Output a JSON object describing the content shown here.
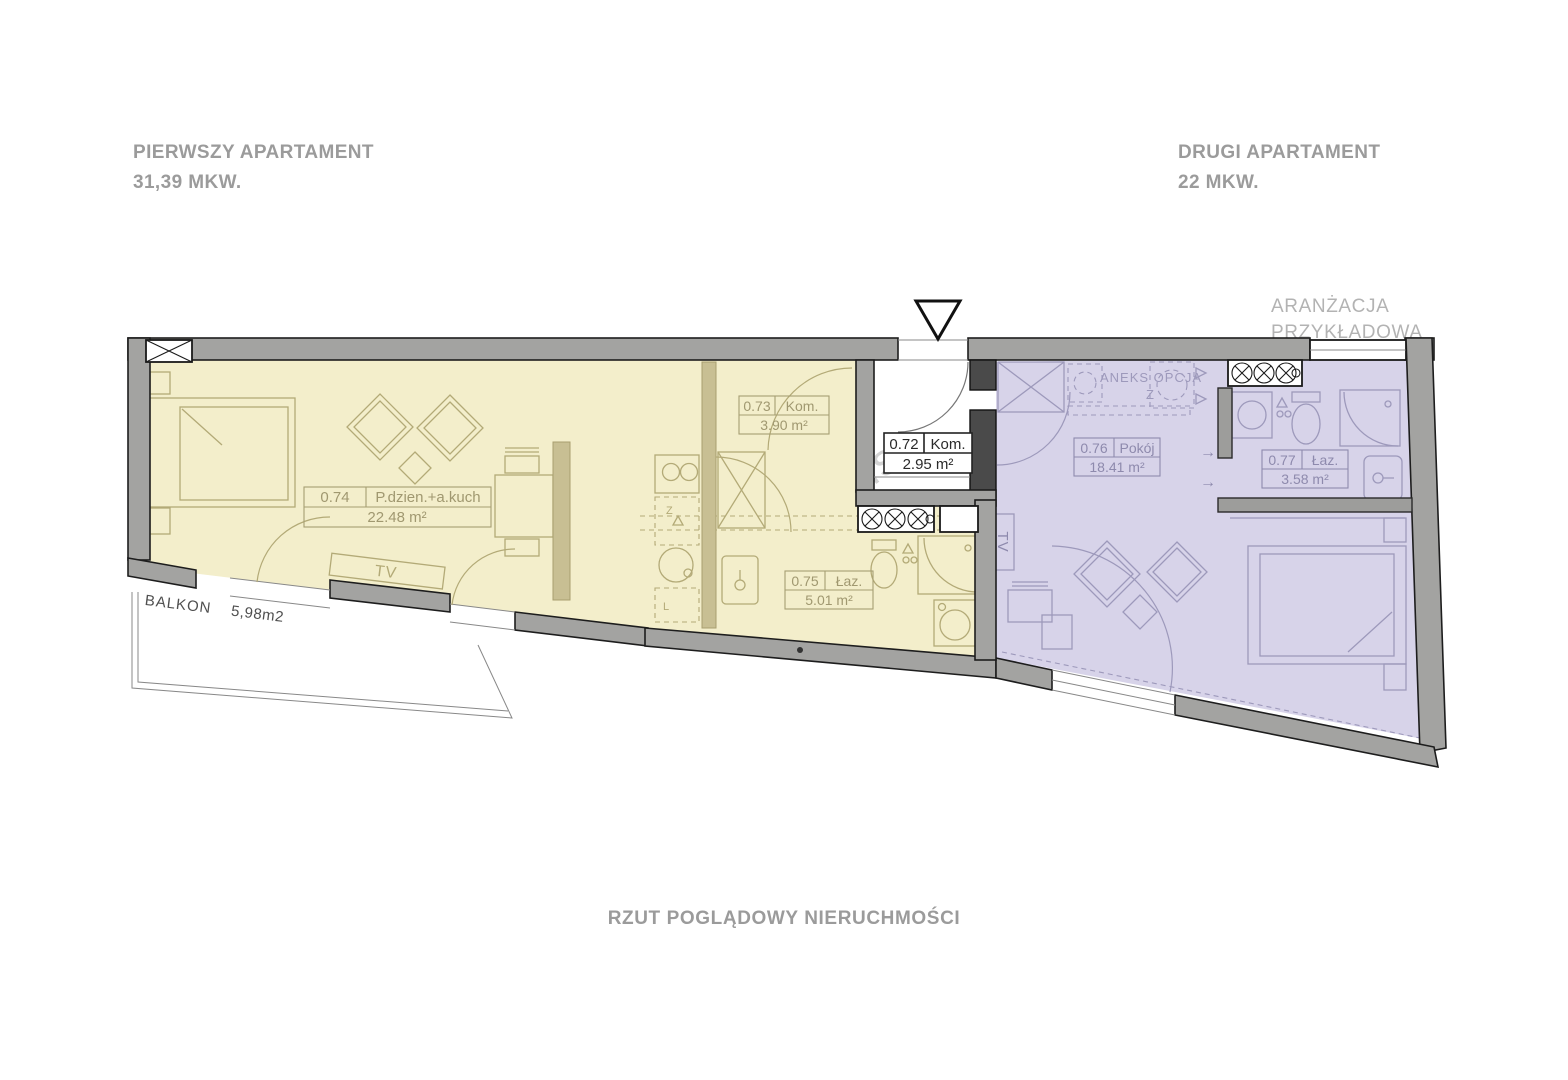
{
  "page": {
    "header_left": {
      "title": "PIERWSZY APARTAMENT",
      "area": "31,39 MKW."
    },
    "header_right": {
      "title": "DRUGI APARTAMENT",
      "area": "22 MKW."
    },
    "arrangement_note": {
      "line1": "ARANŻACJA",
      "line2": "PRZYKŁADOWA"
    },
    "caption": "RZUT POGLĄDOWY NIERUCHMOŚCI",
    "watermark": "metrohouse"
  },
  "plan": {
    "balcony": {
      "label": "BALKON",
      "area": "5,98m2"
    },
    "annex": {
      "label": "ANEKS OPCJA",
      "symbol": "Z"
    },
    "tv_living": "TV",
    "tv_bedroom": "TV",
    "arrow_right": "→",
    "kitchen_symbols": {
      "sink": "Z",
      "fridge": "L"
    },
    "rooms": {
      "r072": {
        "number": "0.72",
        "name": "Kom.",
        "area": "2.95 m²"
      },
      "r073": {
        "number": "0.73",
        "name": "Kom.",
        "area": "3.90 m²"
      },
      "r074": {
        "number": "0.74",
        "name": "P.dzien.+a.kuch",
        "area": "22.48 m²"
      },
      "r075": {
        "number": "0.75",
        "name": "Łaz.",
        "area": "5.01 m²"
      },
      "r076": {
        "number": "0.76",
        "name": "Pokój",
        "area": "18.41 m²"
      },
      "r077": {
        "number": "0.77",
        "name": "Łaz.",
        "area": "3.58 m²"
      }
    }
  },
  "colors": {
    "apartment1_fill": "#f3eecb",
    "apartment2_fill": "#d7d3e9",
    "wall_gray": "#a3a3a1",
    "heading_text": "#9b9b9b",
    "note_text": "#b3b3b3",
    "label_yellow": "#a09870",
    "label_purple": "#8e8aad"
  }
}
